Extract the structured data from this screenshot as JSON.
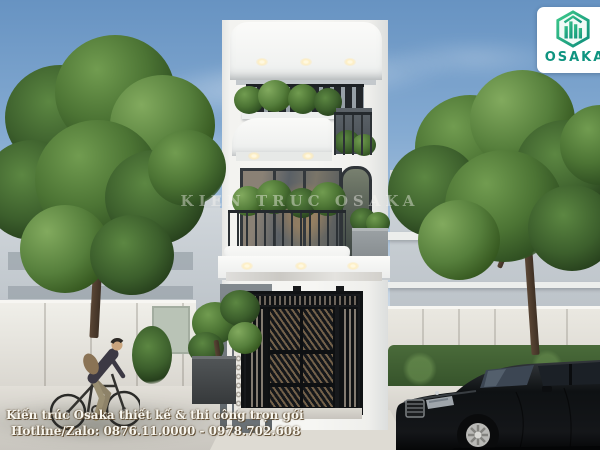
{
  "logo": {
    "text": "OSAKA",
    "brand_color": "#0f9480"
  },
  "watermark": {
    "text": "KIEN TRUC OSAKA"
  },
  "caption": {
    "line1": "Kiến trúc Osaka thiết kế & thi công trọn gói",
    "line2": "Hotline/Zalo: 0876.11.0000 - 0978.702.608"
  },
  "colors": {
    "sky_top": "#6793c2",
    "sky_horizon": "#dbe3ea",
    "house_white": "#f6f6f3",
    "gate_black": "#17191c",
    "foliage_green": "#4c7434",
    "hedge_green": "#35522a",
    "pavement": "#d5d2cb",
    "car_black": "#0c0e10"
  }
}
